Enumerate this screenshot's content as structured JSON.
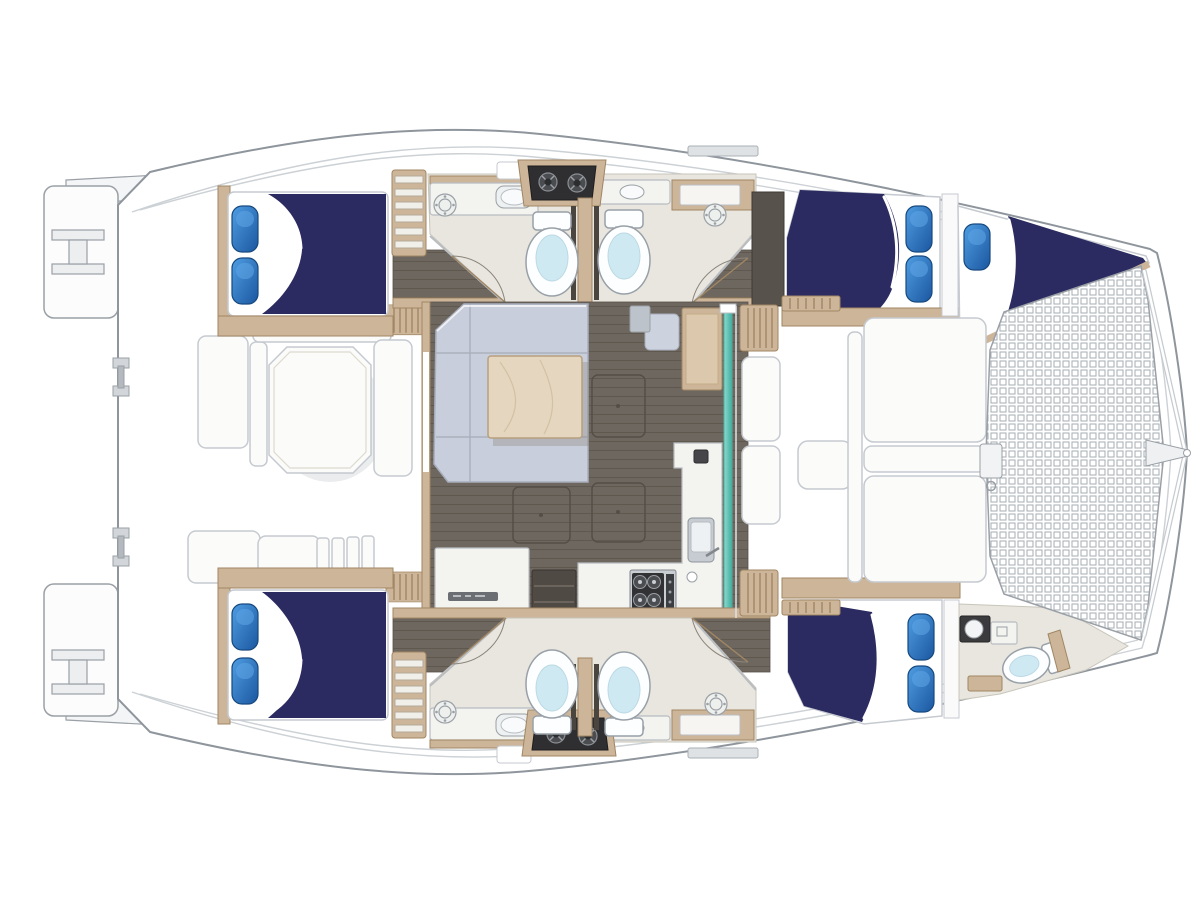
{
  "meta": {
    "title": "Catamaran sailing yacht deck and accommodation floor plan, top-down view, bow to the right",
    "view": "top-down-floor-plan",
    "orientation": "bow-right"
  },
  "colors": {
    "hull_stroke": "#8e959c",
    "deck_line": "#ccd1d5",
    "navy": "#2b2b61",
    "pillow_main": "#2e7bc9",
    "pillow_dark": "#17497f",
    "wood": "#cdb59a",
    "wood_dark": "#a08663",
    "wood_table": "#e4d6bf",
    "floor_dark": "#6e675f",
    "floor_line": "#5f584f",
    "floor_light": "#e8e6de",
    "sofa": "#c8cedb",
    "counter": "#f3f3f0",
    "toilet_water": "#cfe9f3",
    "teal": "#54bfb2",
    "panel": "#2f2f31",
    "white_furniture": "#fbfbfa"
  },
  "vessel": {
    "hulls": 2,
    "double_berths": 4,
    "crew_berths": 1,
    "toilets": 5,
    "sinks": 5,
    "shower_drains": 4,
    "companionway_ladders": 2,
    "port_hull": [
      "aft-double-cabin",
      "companionway-steps",
      "head-compartment",
      "forward-double-cabin",
      "bow-crew-berth"
    ],
    "starboard_hull": [
      "aft-double-cabin",
      "companionway-steps",
      "head-compartment",
      "forward-double-cabin",
      "bow-head-compartment"
    ],
    "salon": [
      "u-shaped-sofa",
      "wood-coffee-table",
      "nav-desk",
      "nav-seat",
      "galley-l-counter",
      "stove",
      "galley-sink",
      "aft-cabinet",
      "floor-hatches",
      "sliding-glass-door"
    ],
    "aft_cockpit": [
      "octagonal-table",
      "bench-seating",
      "sun-lounge",
      "cockpit-steps",
      "entry-grates",
      "swim-platforms",
      "transom-ladders",
      "davit-fittings"
    ],
    "forward_cockpit": [
      "bench-seating",
      "small-table",
      "teak-grates"
    ],
    "foredeck": [
      "trampoline-net",
      "anchor-locker",
      "bowsprit",
      "bridle-lines"
    ]
  }
}
